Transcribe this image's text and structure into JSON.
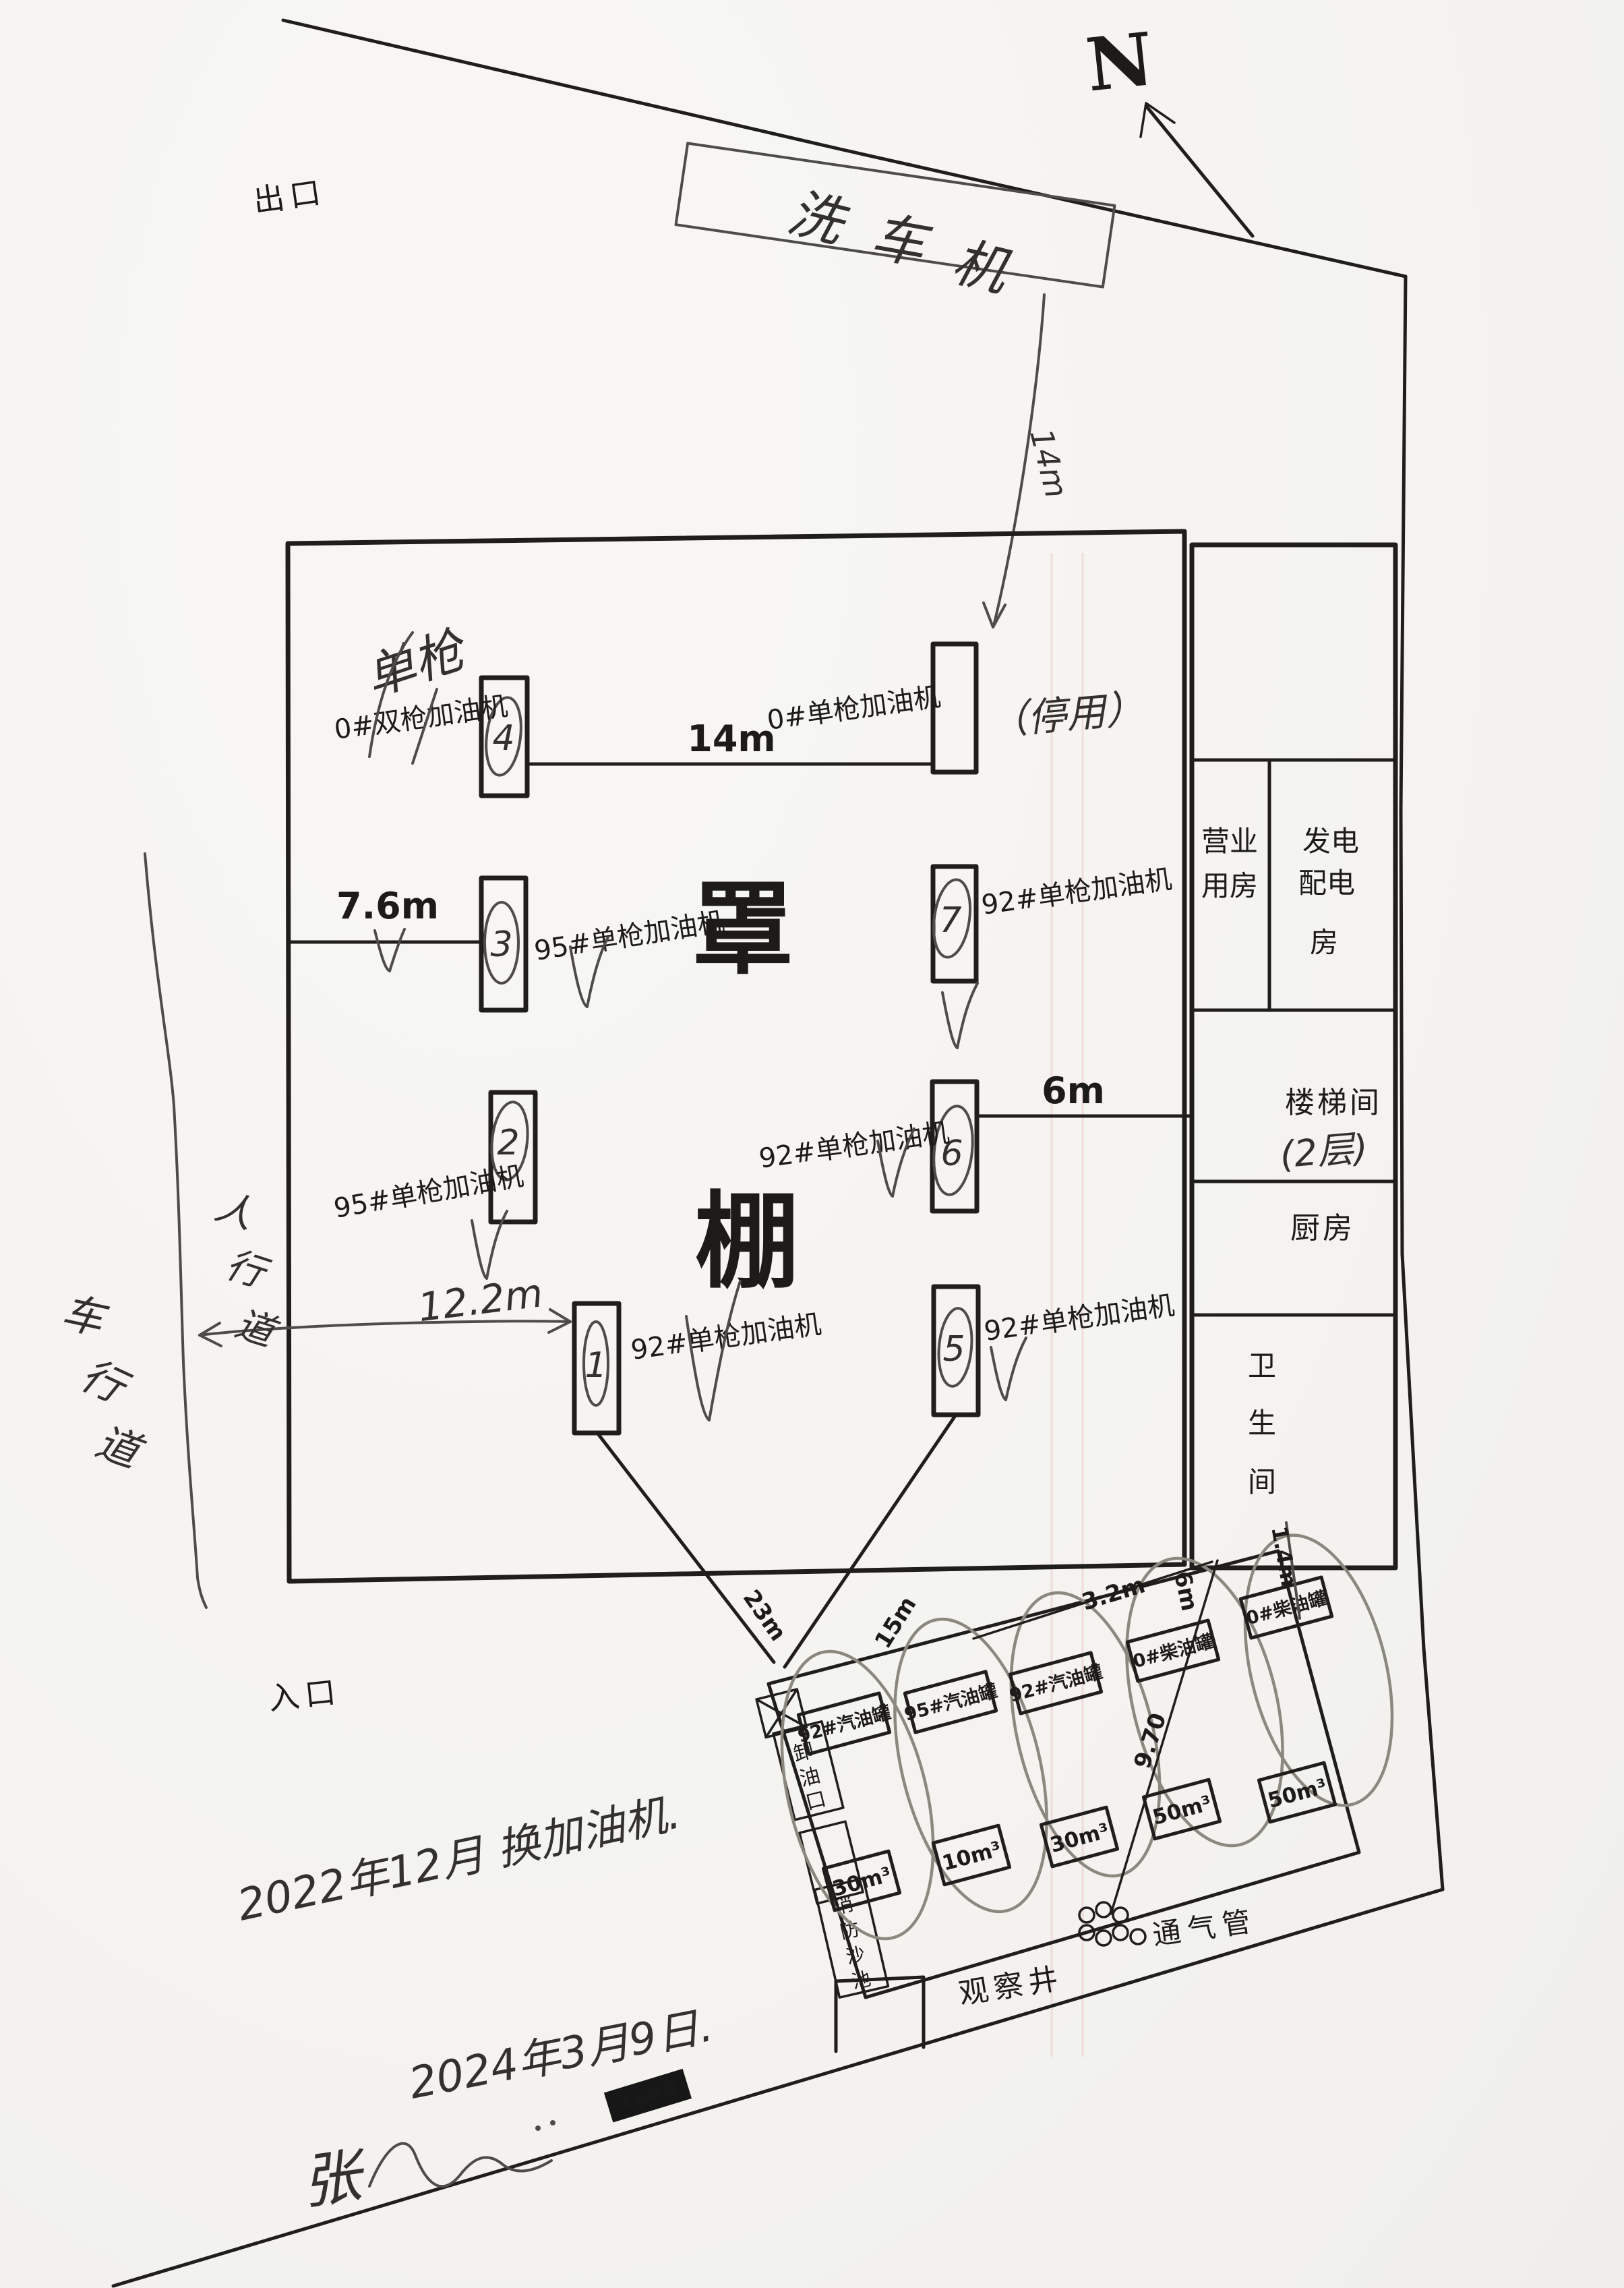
{
  "compass": {
    "label": "N"
  },
  "site": {
    "exit": "出口",
    "entrance": "入口",
    "carwash_chars": [
      "洗",
      "车",
      "机"
    ],
    "canopy_chars": [
      "罩",
      "棚"
    ],
    "sidewalk_chars": [
      "人",
      "行",
      "道"
    ],
    "road_chars": [
      "车",
      "行",
      "道"
    ]
  },
  "dimensions": {
    "row1": "14m",
    "row2_left": "7.6m",
    "row3_right": "6m",
    "row4_left": "12.2m",
    "carwash_arrow": "14m",
    "tank_line_left": "23m",
    "tank_line_right": "15m",
    "tank_gap": "3.2m",
    "tank_gap2": "6m",
    "vent_line": "9.70",
    "washroom_gap": "1.4m"
  },
  "dispensers": [
    {
      "no": "4",
      "label": "0#双枪加油机",
      "note": "单枪"
    },
    {
      "no": "",
      "label": "0#单枪加油机",
      "note": "（停用）"
    },
    {
      "no": "3",
      "label": "95#单枪加油机",
      "note": ""
    },
    {
      "no": "7",
      "label": "92#单枪加油机",
      "note": ""
    },
    {
      "no": "2",
      "label": "95#单枪加油机",
      "note": ""
    },
    {
      "no": "6",
      "label": "92#单枪加油机",
      "note": ""
    },
    {
      "no": "1",
      "label": "92#单枪加油机",
      "note": ""
    },
    {
      "no": "5",
      "label": "92#单枪加油机",
      "note": ""
    }
  ],
  "building": {
    "business_room": [
      "营业",
      "用房"
    ],
    "power_room": [
      "发电",
      "配电",
      "房"
    ],
    "stairwell": "楼梯间",
    "stairwell_note": "(2层)",
    "kitchen": "厨房",
    "washroom": [
      "卫",
      "生",
      "间"
    ]
  },
  "tank_area": {
    "unloading_port": [
      "卸",
      "油",
      "口"
    ],
    "fire_sand_pit": [
      "消",
      "防",
      "沙",
      "池"
    ],
    "tanks": [
      {
        "name": "92#汽油罐",
        "volume": "30m³"
      },
      {
        "name": "95#汽油罐",
        "volume": "10m³"
      },
      {
        "name": "92#汽油罐",
        "volume": "30m³"
      },
      {
        "name": "0#柴油罐",
        "volume": "50m³"
      },
      {
        "name": "0#柴油罐",
        "volume": "50m³"
      }
    ],
    "vent_pipe": "通气管",
    "observation_well": "观察井",
    "fire_extinguisher_box": "灭火器箱"
  },
  "notes": {
    "replacement": "2022年12月 换加油机.",
    "signature": "张",
    "date": "2024年3月9日."
  }
}
